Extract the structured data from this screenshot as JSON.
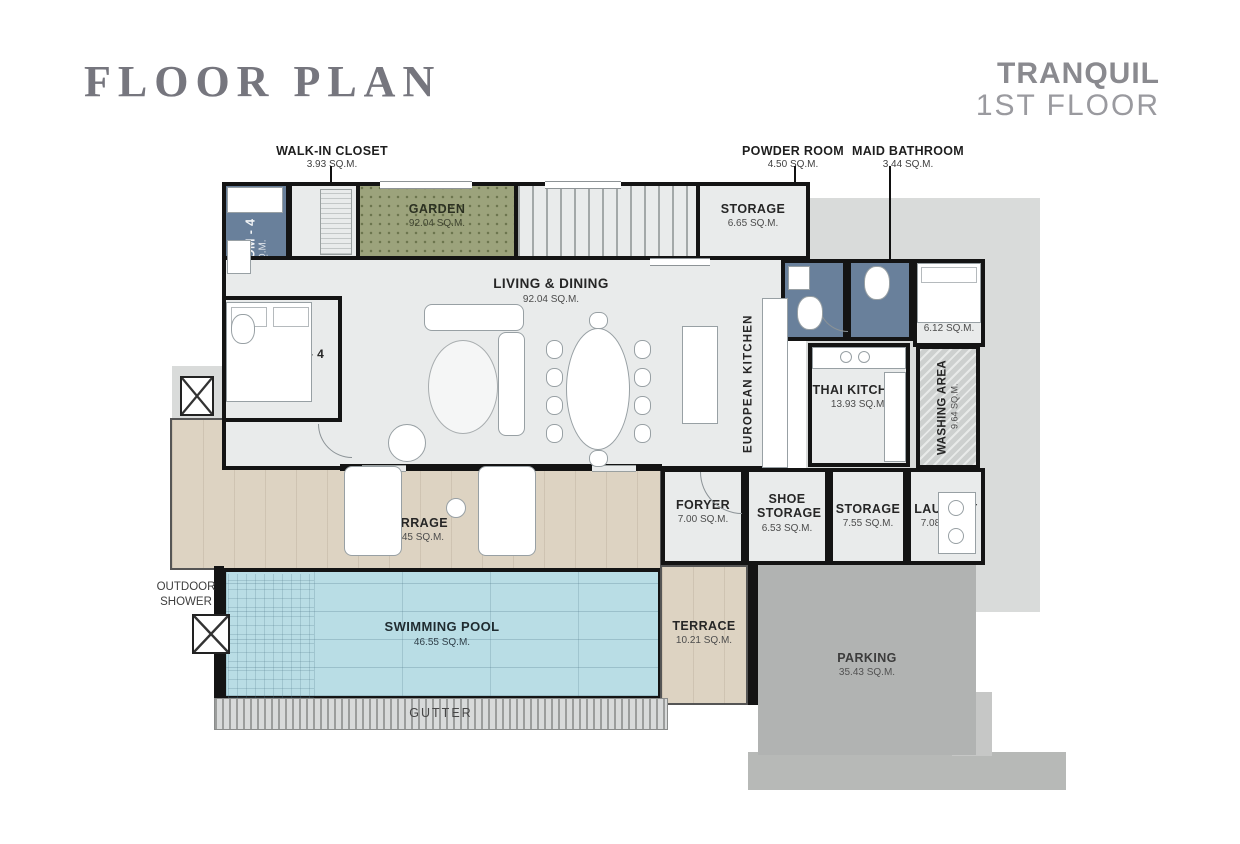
{
  "header": {
    "title": "FLOOR PLAN",
    "project": "TRANQUIL",
    "floor": "1ST FLOOR"
  },
  "callouts": [
    {
      "name": "WALK-IN CLOSET",
      "area": "3.93 SQ.M."
    },
    {
      "name": "POWDER ROOM",
      "area": "4.50 SQ.M."
    },
    {
      "name": "MAID BATHROOM",
      "area": "3.44 SQ.M."
    }
  ],
  "rooms": {
    "bathroom4": {
      "name": "BATHROOM - 4",
      "area": "5.64 SQ.M."
    },
    "bedroom4": {
      "name": "BEDROOM - 4",
      "area": "92.04 SQ.M."
    },
    "garden": {
      "name": "GARDEN",
      "area": "92.04 SQ.M."
    },
    "stairs": {
      "label": "UP"
    },
    "storage_top": {
      "name": "STORAGE",
      "area": "6.65 SQ.M."
    },
    "living_dining": {
      "name": "LIVING & DINING",
      "area": "92.04 SQ.M."
    },
    "european_kitchen": {
      "name": "EUROPEAN KITCHEN"
    },
    "thai_kitchen": {
      "name": "THAI KITCHEN",
      "area": "13.93 SQ.M."
    },
    "maid": {
      "name": "MAID",
      "area": "6.12 SQ.M."
    },
    "washing_area": {
      "name": "WASHING AREA",
      "area": "9.64 SQ.M."
    },
    "foryer": {
      "name": "FORYER",
      "area": "7.00 SQ.M."
    },
    "shoe_storage": {
      "name": "SHOE STORAGE",
      "area": "6.53 SQ.M."
    },
    "storage_mid": {
      "name": "STORAGE",
      "area": "7.55 SQ.M."
    },
    "laundry": {
      "name": "LAUNDRY",
      "area": "7.08 SQ.M."
    },
    "terrace_main": {
      "name": "TERRAGE",
      "area": "60.45 SQ.M."
    },
    "outdoor_shower": {
      "name": "OUTDOOR SHOWER"
    },
    "swimming_pool": {
      "name": "SWIMMING POOL",
      "area": "46.55 SQ.M."
    },
    "terrace_small": {
      "name": "TERRACE",
      "area": "10.21 SQ.M."
    },
    "parking": {
      "name": "PARKING",
      "area": "35.43 SQ.M."
    },
    "gutter": {
      "name": "GUTTER"
    }
  },
  "colors": {
    "wall": "#141414",
    "floor": "#e9ebeb",
    "wet_room": "#69809b",
    "garden": "#9ca37c",
    "terrace": "#ddd3c2",
    "pool": "#b9dde5",
    "parking": "#b1b3b2",
    "site": "#d9dbda",
    "title": "#76767e"
  }
}
